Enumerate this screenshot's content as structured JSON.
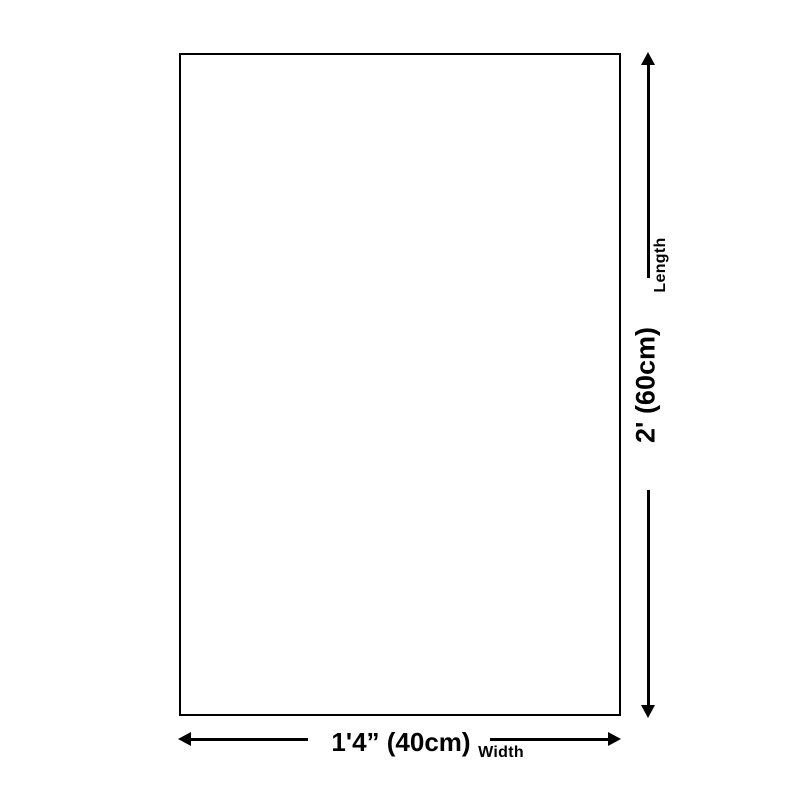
{
  "diagram": {
    "length_dimension": {
      "axis_label": "Length",
      "value_label": "2' (60cm)"
    },
    "width_dimension": {
      "axis_label": "Width",
      "value_label": "1'4” (40cm)"
    }
  },
  "colors": {
    "line": "#000000",
    "background": "#ffffff"
  }
}
